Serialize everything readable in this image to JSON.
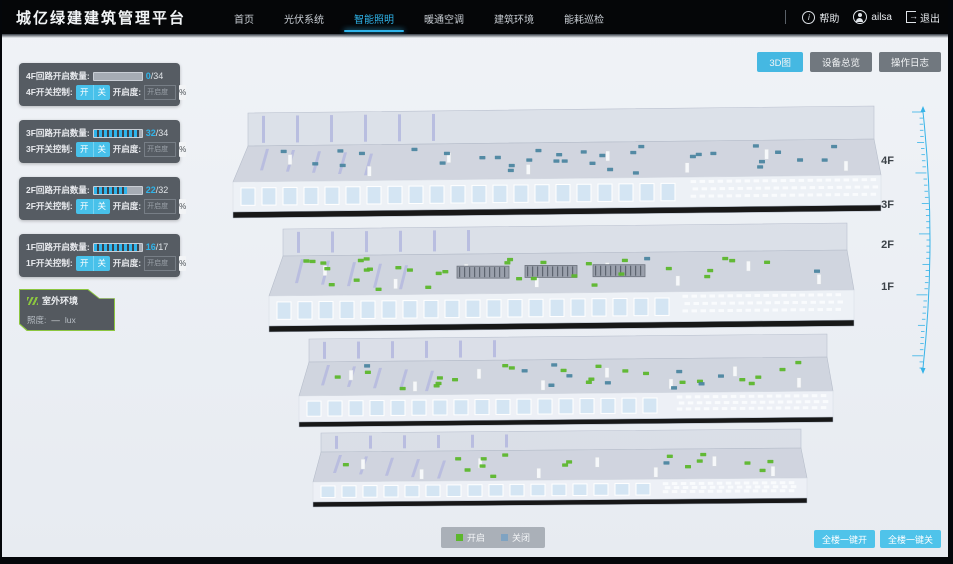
{
  "app": {
    "title": "城亿绿建建筑管理平台"
  },
  "navbar": {
    "menu": [
      {
        "label": "首页",
        "active": false
      },
      {
        "label": "光伏系统",
        "active": false
      },
      {
        "label": "智能照明",
        "active": true
      },
      {
        "label": "暖通空调",
        "active": false
      },
      {
        "label": "建筑环境",
        "active": false
      },
      {
        "label": "能耗巡检",
        "active": false
      }
    ],
    "help": "帮助",
    "user": "ailsa",
    "logout": "退出"
  },
  "view_buttons": [
    {
      "label": "3D图",
      "active": true
    },
    {
      "label": "设备总览",
      "active": false
    },
    {
      "label": "操作日志",
      "active": false
    }
  ],
  "floors": [
    {
      "id": "4F",
      "circuit_label": "4F回路开启数量:",
      "open": 0,
      "total": 34,
      "open_text": "0",
      "total_text": "/34",
      "switch_label": "4F开关控制:",
      "on_label": "开",
      "off_label": "关",
      "openness_label": "开启度:",
      "openness_placeholder": "开启度",
      "percent_label": "%"
    },
    {
      "id": "3F",
      "circuit_label": "3F回路开启数量:",
      "open": 32,
      "total": 34,
      "open_text": "32",
      "total_text": "/34",
      "switch_label": "3F开关控制:",
      "on_label": "开",
      "off_label": "关",
      "openness_label": "开启度:",
      "openness_placeholder": "开启度",
      "percent_label": "%"
    },
    {
      "id": "2F",
      "circuit_label": "2F回路开启数量:",
      "open": 22,
      "total": 32,
      "open_text": "22",
      "total_text": "/32",
      "switch_label": "2F开关控制:",
      "on_label": "开",
      "off_label": "关",
      "openness_label": "开启度:",
      "openness_placeholder": "开启度",
      "percent_label": "%"
    },
    {
      "id": "1F",
      "circuit_label": "1F回路开启数量:",
      "open": 16,
      "total": 17,
      "open_text": "16",
      "total_text": "/17",
      "switch_label": "1F开关控制:",
      "on_label": "开",
      "off_label": "关",
      "openness_label": "开启度:",
      "openness_placeholder": "开启度",
      "percent_label": "%"
    }
  ],
  "outdoor": {
    "title": "室外环境",
    "metric_label": "照度:",
    "metric_value": "—",
    "metric_unit": "lux"
  },
  "floor_markers": [
    "4F",
    "3F",
    "2F",
    "1F"
  ],
  "legend": {
    "on_label": "开启",
    "off_label": "关闭",
    "on_color": "#5cb72c",
    "off_color": "#7fa3c2"
  },
  "bulk_buttons": [
    {
      "label": "全楼一键开"
    },
    {
      "label": "全楼一键关"
    }
  ],
  "colors": {
    "accent": "#2fb4ea",
    "panel": "#494f56",
    "open_dot": "#5cb72c",
    "closed_dot": "#4c86a0"
  }
}
